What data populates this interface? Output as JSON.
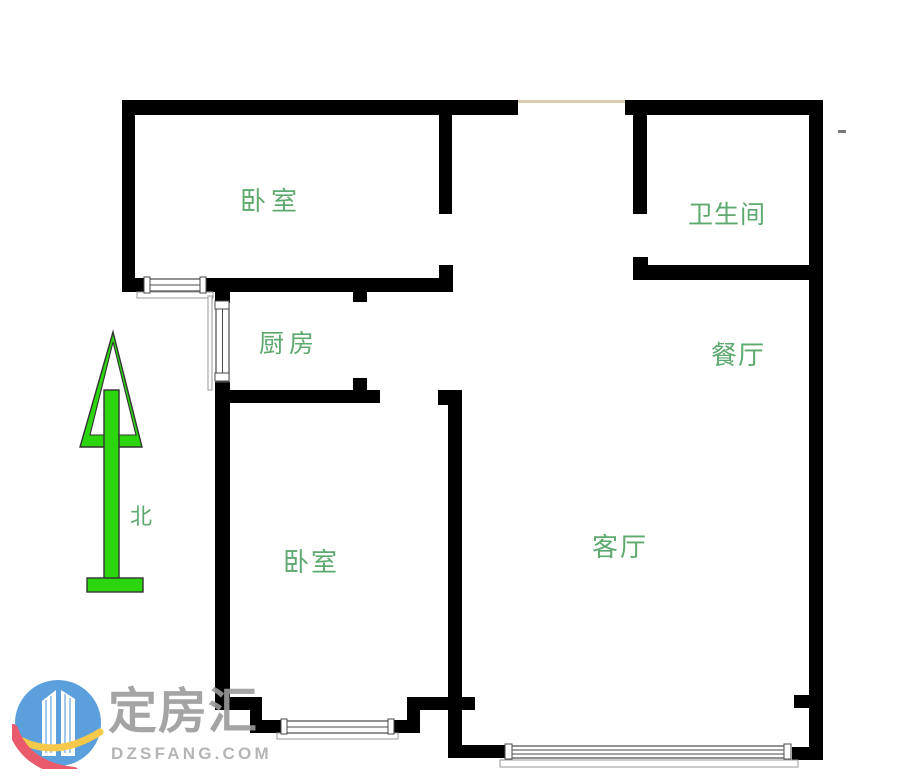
{
  "canvas": {
    "width": 900,
    "height": 781,
    "background": "#ffffff"
  },
  "floor_plan": {
    "rooms": [
      {
        "id": "bedroom-top",
        "label": "卧室"
      },
      {
        "id": "bathroom",
        "label": "卫生间"
      },
      {
        "id": "kitchen",
        "label": "厨房"
      },
      {
        "id": "dining-room",
        "label": "餐厅"
      },
      {
        "id": "bedroom-left",
        "label": "卧室"
      },
      {
        "id": "living-room",
        "label": "客厅"
      }
    ],
    "compass": {
      "label": "北",
      "direction": "north"
    },
    "colors": {
      "wall_fill": "#2bd60e",
      "wall_outline": "#333333",
      "label_text": "#5da96e",
      "window_outline": "#4a4a4a",
      "sill_outline": "#999999",
      "entry_line": "#d8cdb0",
      "dash_mark": "#777777"
    }
  },
  "watermark": {
    "brand": "定房汇",
    "domain": "DZSFANG.COM",
    "colors": {
      "brand_text": "#9b9b9b",
      "domain_text": "#aeaeae",
      "logo_blue": "#4a95da",
      "logo_yellow": "#f6c437",
      "logo_red": "#e8495e",
      "tower_line": "#6aa8e0"
    }
  }
}
